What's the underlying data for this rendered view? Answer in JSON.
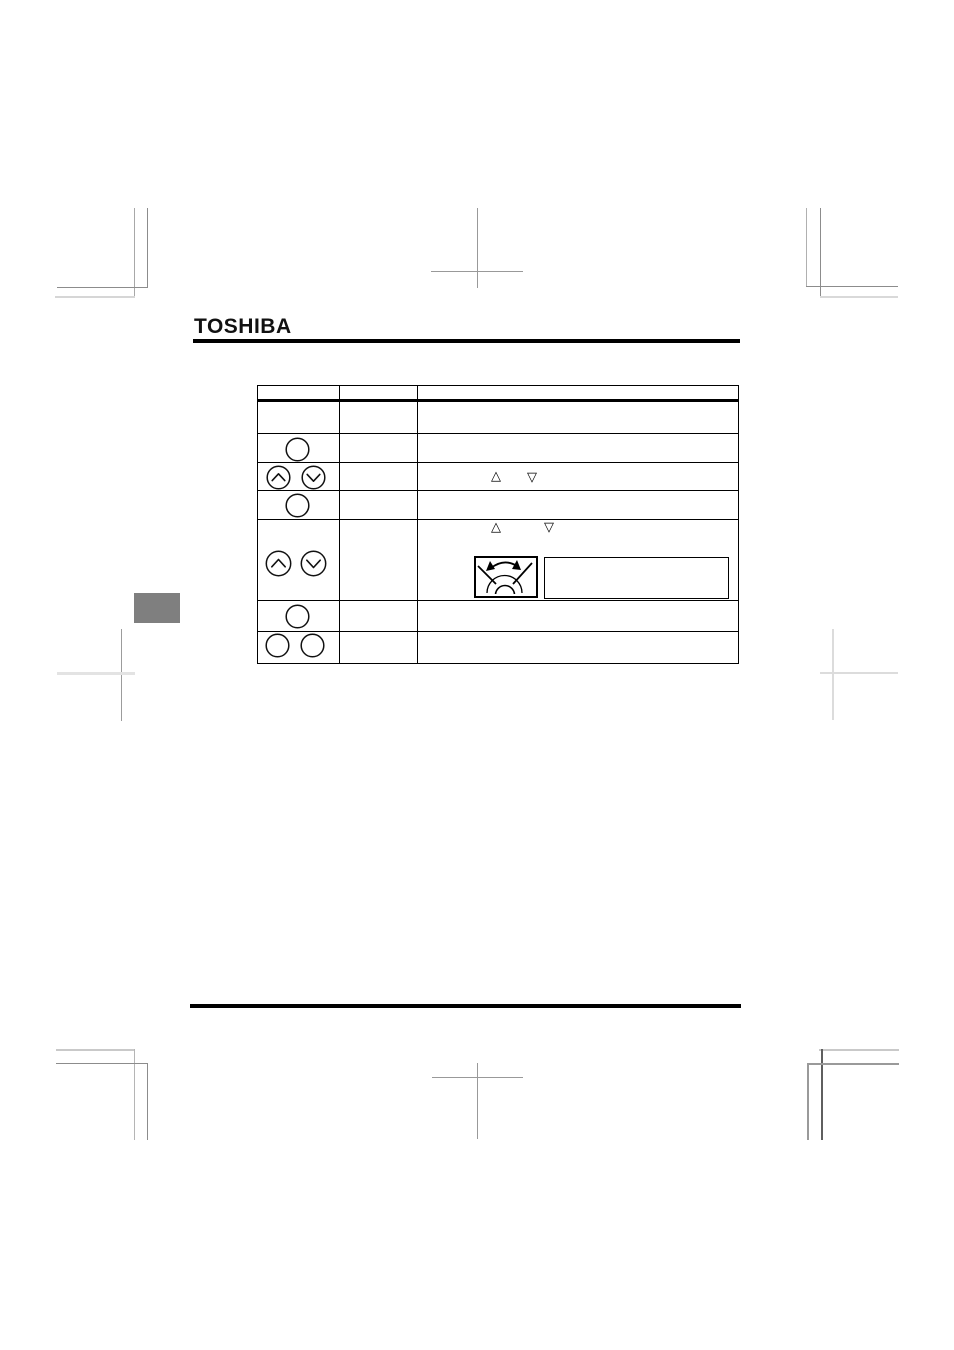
{
  "page": {
    "width": 954,
    "height": 1350,
    "background": "#ffffff"
  },
  "brand": {
    "logo_text": "TOSHIBA"
  },
  "colors": {
    "ink": "#000000",
    "section_marker_gray": "#7f7f7f",
    "crop_mark_dark": "#8c8c8c",
    "crop_mark_mid": "#999999",
    "crop_mark_light": "#d9d9d9"
  },
  "table": {
    "columns": [
      "",
      "",
      ""
    ],
    "glyphs": {
      "triangle_up": "△",
      "triangle_down": "▽"
    },
    "rows": [
      {
        "index": 1,
        "button_icons": [],
        "description_icons": []
      },
      {
        "index": 2,
        "button_icons": [
          "circle-button"
        ],
        "description_icons": []
      },
      {
        "index": 3,
        "button_icons": [
          "up-circle-button",
          "down-circle-button"
        ],
        "description_icons": [
          "triangle-up",
          "triangle-down"
        ]
      },
      {
        "index": 4,
        "button_icons": [
          "circle-button"
        ],
        "description_icons": []
      },
      {
        "index": 5,
        "button_icons": [
          "up-circle-button",
          "down-circle-button"
        ],
        "description_icons": [
          "triangle-up",
          "triangle-down",
          "rotary-dial-figure",
          "empty-box"
        ]
      },
      {
        "index": 6,
        "button_icons": [
          "circle-button"
        ],
        "description_icons": []
      },
      {
        "index": 7,
        "button_icons": [
          "circle-button",
          "circle-button"
        ],
        "description_icons": []
      }
    ]
  }
}
